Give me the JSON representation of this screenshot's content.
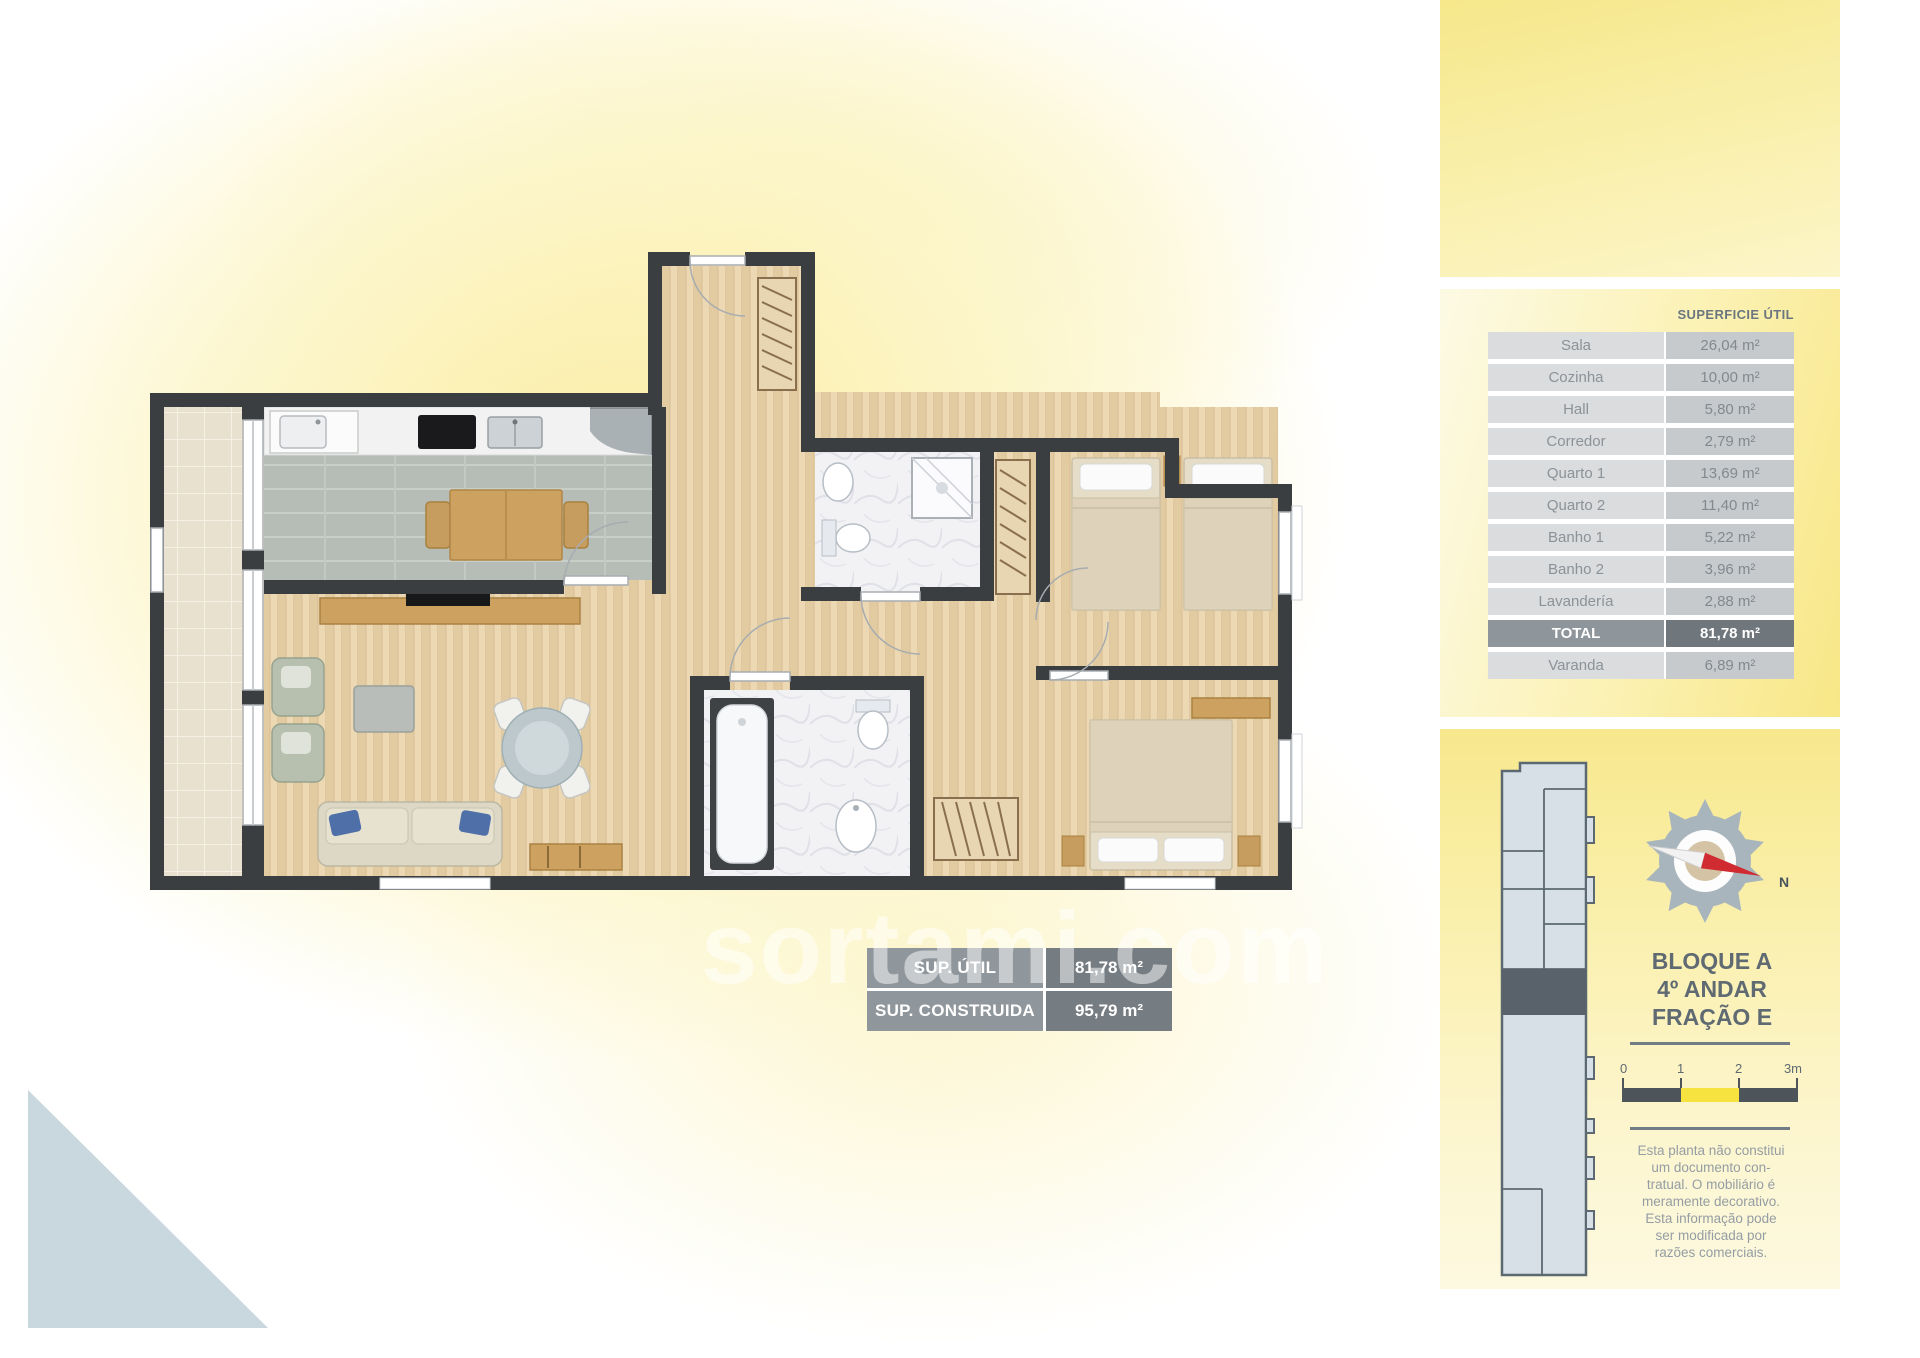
{
  "watermark": "sortami.com",
  "surface_table": {
    "header": "SUPERFICIE ÚTIL",
    "rows": [
      {
        "label": "Sala",
        "value": "26,04 m²"
      },
      {
        "label": "Cozinha",
        "value": "10,00 m²"
      },
      {
        "label": "Hall",
        "value": "5,80 m²"
      },
      {
        "label": "Corredor",
        "value": "2,79 m²"
      },
      {
        "label": "Quarto 1",
        "value": "13,69 m²"
      },
      {
        "label": "Quarto 2",
        "value": "11,40 m²"
      },
      {
        "label": "Banho 1",
        "value": "5,22 m²"
      },
      {
        "label": "Banho 2",
        "value": "3,96 m²"
      },
      {
        "label": "Lavandería",
        "value": "2,88 m²"
      },
      {
        "label": "TOTAL",
        "value": "81,78 m²"
      },
      {
        "label": "Varanda",
        "value": "6,89 m²"
      }
    ]
  },
  "summary_badges": {
    "rows": [
      {
        "label": "SUP. ÚTIL",
        "value": "81,78 m²"
      },
      {
        "label": "SUP. CONSTRUIDA",
        "value": "95,79 m²"
      }
    ]
  },
  "unit_info": {
    "lines": [
      "BLOQUE A",
      "4º ANDAR",
      "FRAÇÃO E"
    ]
  },
  "compass": {
    "north_label": "N"
  },
  "scale_bar": {
    "labels": [
      "0",
      "1",
      "2",
      "3m"
    ]
  },
  "disclaimer": {
    "lines": [
      "Esta planta não constitui",
      "um documento con-",
      "tratual. O mobiliário é",
      "meramente decorativo.",
      "Esta informação pode",
      "ser modificada por",
      "razões comerciais."
    ]
  },
  "colors": {
    "accent_yellow": "#f7e33f",
    "panel_yellow": "#f8e787",
    "wall_dark": "#3b3e41",
    "table_label_gray": "#dadcde",
    "table_value_gray": "#c6cacc",
    "total_gray": "#6f767c",
    "keyplan_blue": "#d7e0e6",
    "needle_red": "#cf2b30"
  }
}
